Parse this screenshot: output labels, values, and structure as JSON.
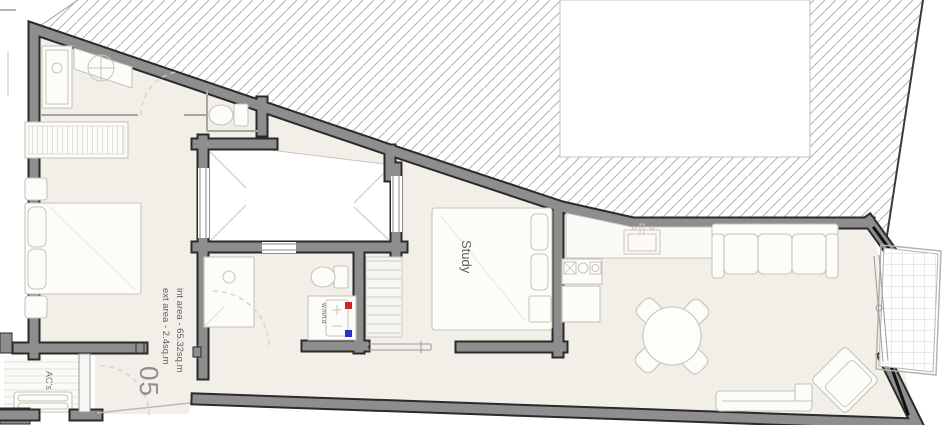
{
  "document": {
    "type": "architectural floor plan",
    "unit_number": "05"
  },
  "labels": {
    "study_room": "Study",
    "internal_area": "int area - 65.32sq.m",
    "external_area": "ext area - 2.4sq.m",
    "unit_number": "05",
    "ac_units": "AC's",
    "washer_dryer": "w.m/t.d"
  },
  "colors": {
    "background": "#ffffff",
    "floor": "#f1efe8",
    "wall_fill": "#8e8e8e",
    "wall_outline": "#2a2a2a",
    "hatch_line": "#b3b1ab",
    "furniture_line": "#c7c4ba",
    "label_text": "#5f5f5f",
    "unit_number_text": "#8f8f8f",
    "washer_hot_point": "#cc2626",
    "washer_cold_point": "#2433c8"
  }
}
